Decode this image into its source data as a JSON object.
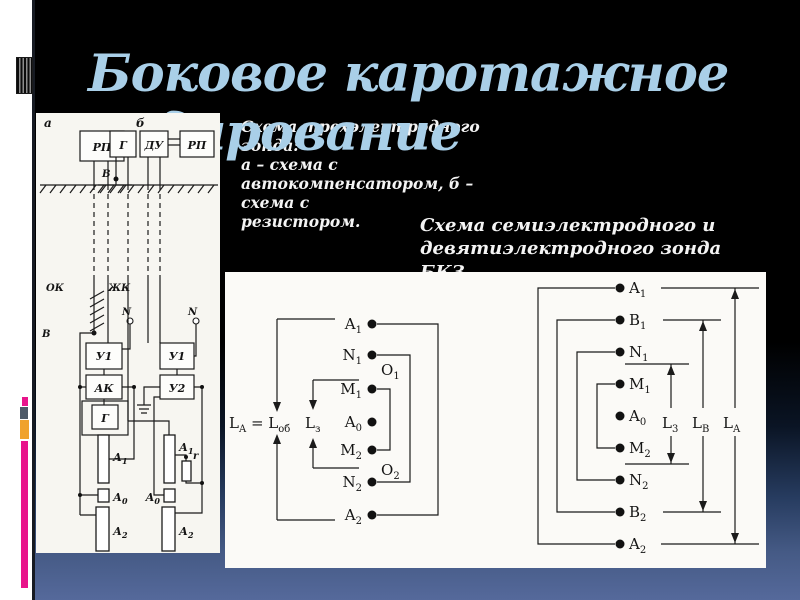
{
  "slide": {
    "title": {
      "line1": "Боковое каротажное",
      "line2": "зондирование"
    },
    "captions": {
      "three_electrode": [
        "Схема трехэлектродного зонда:",
        "а – схема с",
        "автокомпенсатором, б – схема с",
        "резистором."
      ],
      "bkz": [
        "Схема семиэлектродного и",
        "девятиэлектродного зонда БКЗ"
      ]
    },
    "colors": {
      "title_blue": "#a9cfe8",
      "background_top": "#000000",
      "background_bottom": "#55699b",
      "accent_magenta": "#e8148b",
      "accent_orange": "#f0a22c",
      "accent_slate": "#4e5a68",
      "accent_pink": "#e8148b"
    }
  },
  "three_electrode_diagram": {
    "scheme_labels": {
      "a": "а",
      "b": "б"
    },
    "surface_units": {
      "rp_a": "РП",
      "g_b": "Г",
      "du_b": "ДУ",
      "rp_b": "РП"
    },
    "downhole_units": {
      "u1_a": "У1",
      "ak_a": "АК",
      "g_a": "Г",
      "u1_b": "У1",
      "u2_b": "У2"
    },
    "wire_labels": {
      "v_a": "В",
      "v_b": "В",
      "ok": "ОК",
      "zhk": "ЖК",
      "n_a": "N",
      "n_b": "N",
      "r_b": "r"
    },
    "electrodes_a": [
      {
        "m": "А",
        "s": "1"
      },
      {
        "m": "А",
        "s": "0"
      },
      {
        "m": "А",
        "s": "2"
      }
    ],
    "electrodes_b": [
      {
        "m": "А",
        "s": "1"
      },
      {
        "m": "А",
        "s": "0"
      },
      {
        "m": "А",
        "s": "2"
      }
    ]
  },
  "bkz_diagram": {
    "seven_electrode": {
      "electrodes": [
        {
          "m": "A",
          "s": "1"
        },
        {
          "m": "N",
          "s": "1"
        },
        {
          "m": "M",
          "s": "1"
        },
        {
          "m": "A",
          "s": "0"
        },
        {
          "m": "M",
          "s": "2"
        },
        {
          "m": "N",
          "s": "2"
        },
        {
          "m": "A",
          "s": "2"
        }
      ],
      "points": {
        "o1": {
          "m": "O",
          "s": "1"
        },
        "o2": {
          "m": "O",
          "s": "2"
        }
      },
      "eq": {
        "p1": "L",
        "s1": "A",
        "p2": " = L",
        "s2": "об"
      },
      "lz": {
        "m": "L",
        "s": "з"
      }
    },
    "nine_electrode": {
      "electrodes": [
        {
          "m": "A",
          "s": "1"
        },
        {
          "m": "B",
          "s": "1"
        },
        {
          "m": "N",
          "s": "1"
        },
        {
          "m": "M",
          "s": "1"
        },
        {
          "m": "A",
          "s": "0"
        },
        {
          "m": "M",
          "s": "2"
        },
        {
          "m": "N",
          "s": "2"
        },
        {
          "m": "B",
          "s": "2"
        },
        {
          "m": "A",
          "s": "2"
        }
      ],
      "dims": {
        "l3": {
          "m": "L",
          "s": "3"
        },
        "lb": {
          "m": "L",
          "s": "B"
        },
        "la": {
          "m": "L",
          "s": "A"
        }
      }
    }
  }
}
